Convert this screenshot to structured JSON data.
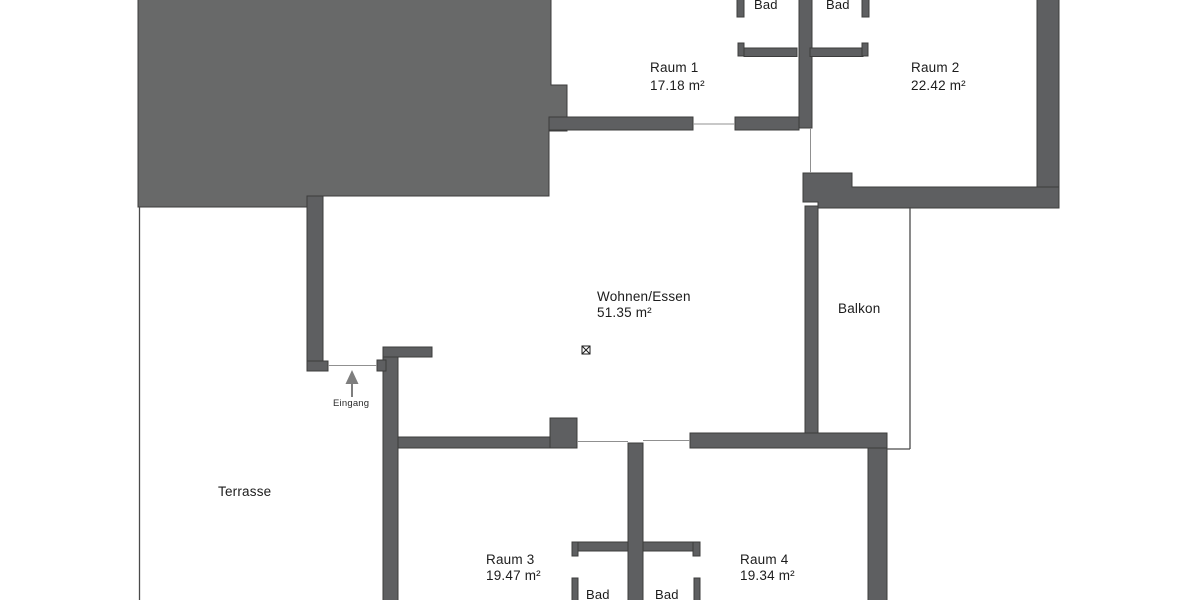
{
  "plan": {
    "rooms": {
      "bad_top_left": {
        "label": "Bad"
      },
      "bad_top_right": {
        "label": "Bad"
      },
      "raum1": {
        "label": "Raum 1",
        "area": "17.18 m²"
      },
      "raum2": {
        "label": "Raum 2",
        "area": "22.42 m²"
      },
      "wohnen_essen": {
        "label": "Wohnen/Essen",
        "area": "51.35 m²"
      },
      "balkon": {
        "label": "Balkon"
      },
      "terrasse": {
        "label": "Terrasse"
      },
      "raum3": {
        "label": "Raum 3",
        "area": "19.47 m²"
      },
      "raum4": {
        "label": "Raum 4",
        "area": "19.34 m²"
      },
      "bad_bottom_left": {
        "label": "Bad"
      },
      "bad_bottom_right": {
        "label": "Bad"
      }
    },
    "entrance": {
      "label": "Eingang"
    },
    "colors": {
      "wall": "#5e5f61",
      "building_block": "#686969",
      "outline": "#3c3c3c",
      "thin_line": "#4a4a4a",
      "door_line": "#909090",
      "arrow": "#7e7e7e",
      "text": "#1c1c1c",
      "background": "#ffffff"
    }
  }
}
